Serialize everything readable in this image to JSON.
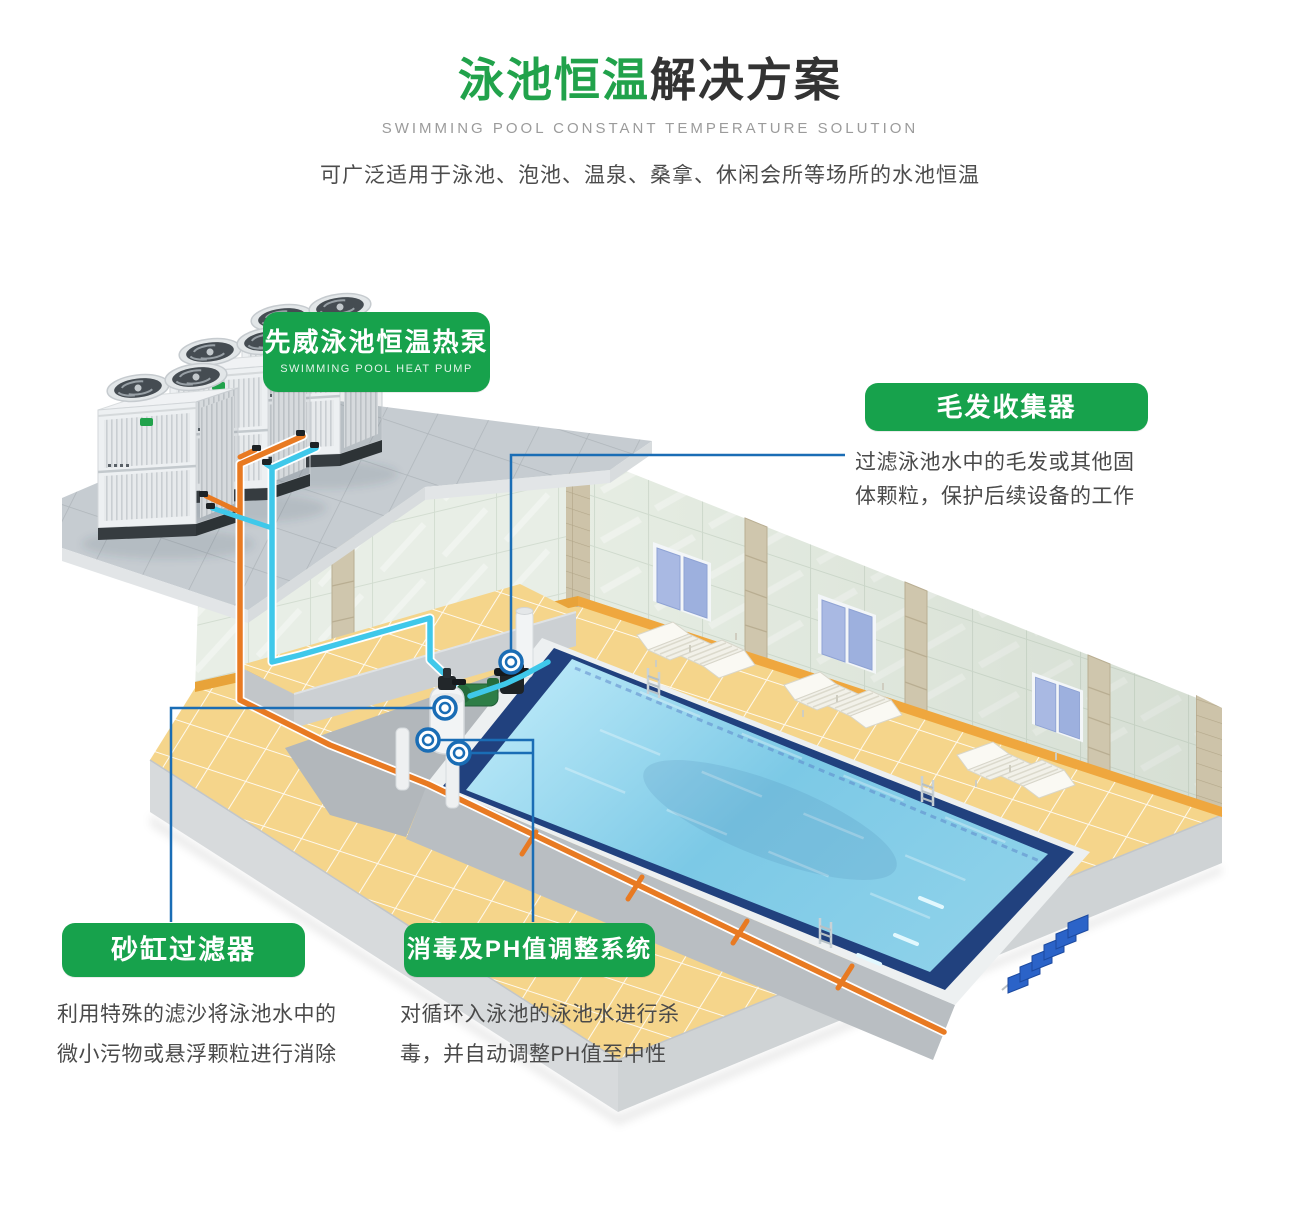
{
  "header": {
    "title_highlight": "泳池恒温",
    "title_rest": "解决方案",
    "subtitle_en": "SWIMMING POOL CONSTANT TEMPERATURE SOLUTION",
    "description": "可广泛适用于泳池、泡池、温泉、桑拿、休闲会所等场所的水池恒温"
  },
  "labels": {
    "heat_pump": {
      "title": "先威泳池恒温热泵",
      "subtitle_en": "SWIMMING POOL HEAT PUMP"
    },
    "hair_collector": {
      "title": "毛发收集器",
      "desc_line1": "过滤泳池水中的毛发或其他固",
      "desc_line2": "体颗粒，保护后续设备的工作"
    },
    "sand_filter": {
      "title": "砂缸过滤器",
      "desc_line1": "利用特殊的滤沙将泳池水中的",
      "desc_line2": "微小污物或悬浮颗粒进行消除"
    },
    "ph_system": {
      "title": "消毒及PH值调整系统",
      "desc_line1": "对循环入泳池的泳池水进行杀",
      "desc_line2": "毒，并自动调整PH值至中性"
    }
  },
  "illustration": {
    "heat_pump_units": 3,
    "lounger_pairs": 3,
    "windows": 3,
    "bench_seats": 6,
    "callout_markers": 4
  },
  "colors": {
    "brand_green": "#17a24c",
    "title_green": "#21a24b",
    "title_dark": "#333333",
    "subtitle_gray": "#9b9b9b",
    "body_text_gray": "#4a4a4a",
    "callout_blue": "#1a6db5",
    "pipe_orange": "#e87a22",
    "pipe_cyan": "#3fc8ea",
    "pool_water_blue": "#7cc9e6",
    "pool_border_navy": "#21417e",
    "floor_yellow": "#f5d58b",
    "wall_tile": "#e6ede3"
  }
}
